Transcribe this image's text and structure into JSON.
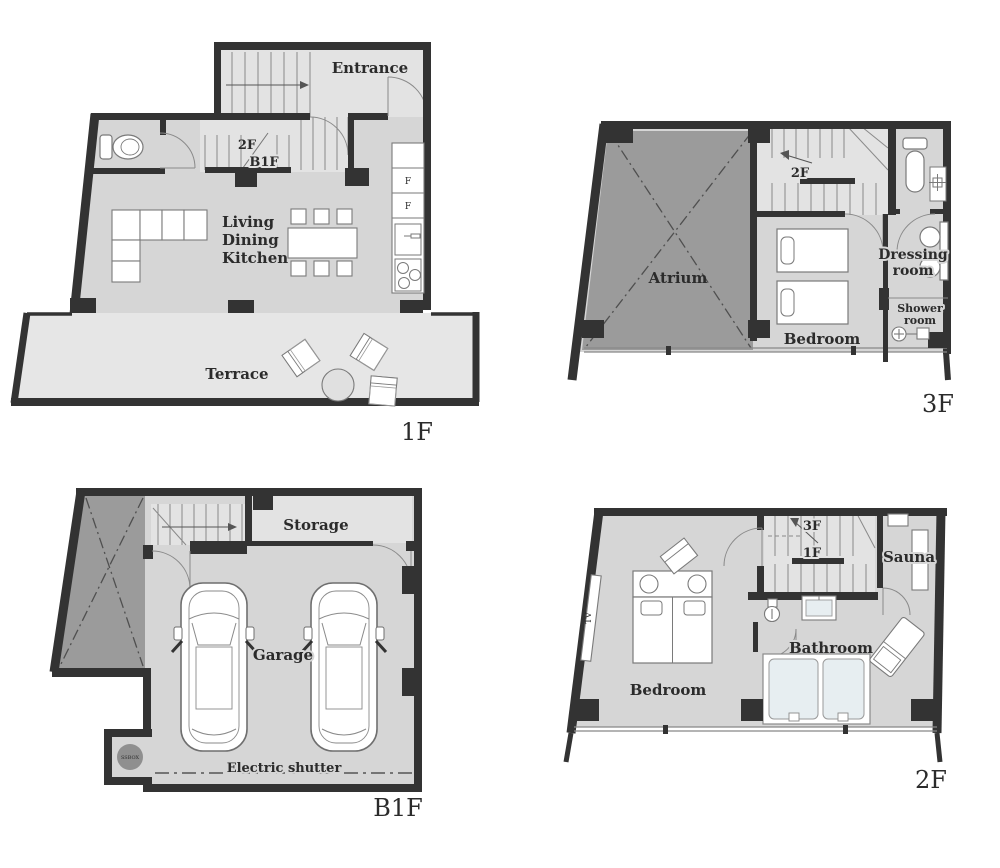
{
  "floors": {
    "f1": {
      "label": "1F",
      "entrance": "Entrance",
      "stair_up": "2F",
      "stair_down": "B1F",
      "ldk1": "Living",
      "ldk2": "Dining",
      "ldk3": "Kitchen",
      "fridge": "F",
      "freezer": "F",
      "terrace": "Terrace"
    },
    "f3": {
      "label": "3F",
      "atrium": "Atrium",
      "stair_down": "2F",
      "bedroom": "Bedroom",
      "dressing1": "Dressing",
      "dressing2": "room",
      "shower1": "Shower",
      "shower2": "room"
    },
    "b1f": {
      "label": "B1F",
      "storage": "Storage",
      "garage": "Garage",
      "ssbox": "SSBOX",
      "shutter": "Electric shutter"
    },
    "f2": {
      "label": "2F",
      "stair_up": "3F",
      "stair_down": "1F",
      "sauna": "Sauna",
      "bathroom": "Bathroom",
      "bedroom": "Bedroom",
      "tv": "TV"
    }
  },
  "colors": {
    "wall": "#333333",
    "floor": "#d6d6d6",
    "floor_light": "#e3e3e3",
    "void_gray": "#9b9b9b",
    "water": "#e7eef1"
  }
}
